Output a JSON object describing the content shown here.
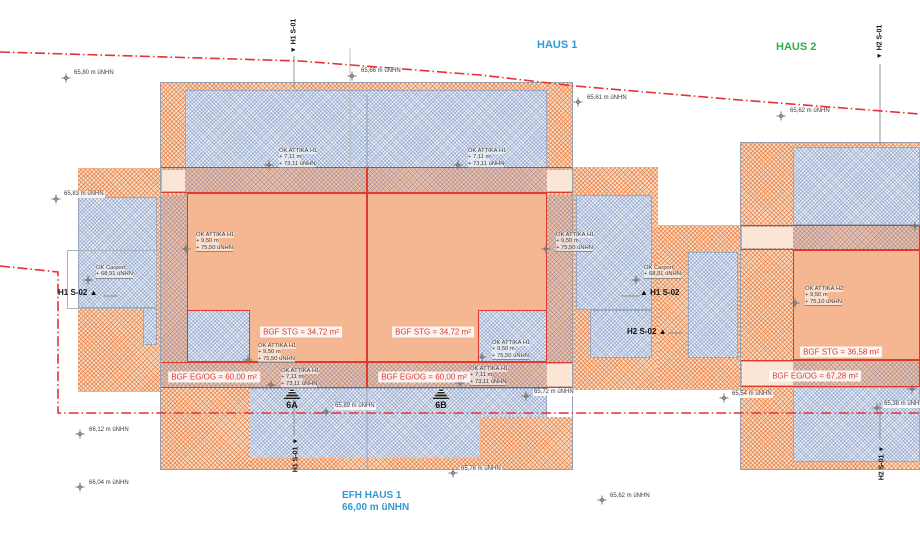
{
  "titles": {
    "haus1": "HAUS 1",
    "haus2": "HAUS 2",
    "efh_line1": "EFH HAUS 1",
    "efh_line2": "66,00 m üNHN"
  },
  "colors": {
    "haus1_title": "#2e9bd6",
    "haus2_title": "#2fae4e",
    "bgf_text": "#e0342c",
    "boundary_red": "#e63137"
  },
  "elevation_markers": [
    {
      "label": "65,80 m üNHN",
      "x": 73,
      "y": 70,
      "cx": 66,
      "cy": 78
    },
    {
      "label": "65,66 m üNHN",
      "x": 360,
      "y": 68,
      "cx": 352,
      "cy": 76
    },
    {
      "label": "65,61 m üNHN",
      "x": 586,
      "y": 95,
      "cx": 578,
      "cy": 102
    },
    {
      "label": "65,62 m üNHN",
      "x": 789,
      "y": 108,
      "cx": 781,
      "cy": 116
    },
    {
      "label": "65,83 m üNHN",
      "x": 63,
      "y": 191,
      "cx": 56,
      "cy": 199
    },
    {
      "label": "65,89 m üNHN",
      "x": 334,
      "y": 403,
      "cx": 326,
      "cy": 412
    },
    {
      "label": "65,72 m üNHN",
      "x": 533,
      "y": 389,
      "cx": 526,
      "cy": 396
    },
    {
      "label": "65,54 m üNHN",
      "x": 731,
      "y": 391,
      "cx": 724,
      "cy": 398
    },
    {
      "label": "65,38 m üNHN",
      "x": 883,
      "y": 401,
      "cx": 877,
      "cy": 408
    },
    {
      "label": "66,12 m üNHN",
      "x": 88,
      "y": 427,
      "cx": 80,
      "cy": 434
    },
    {
      "label": "66,04 m üNHN",
      "x": 88,
      "y": 480,
      "cx": 80,
      "cy": 487
    },
    {
      "label": "65,76 m üNHN",
      "x": 460,
      "y": 466,
      "cx": 453,
      "cy": 473
    },
    {
      "label": "65,62 m üNHN",
      "x": 609,
      "y": 493,
      "cx": 602,
      "cy": 500
    },
    {
      "label": "",
      "x": 0,
      "y": 0,
      "cx": 915,
      "cy": 226
    },
    {
      "label": "",
      "x": 0,
      "y": 0,
      "cx": 912,
      "cy": 389
    }
  ],
  "carport_markers": [
    {
      "lines": [
        "OK Carport",
        "+ 68,91 üNHN"
      ],
      "x": 96,
      "y": 265,
      "cx": 88,
      "cy": 280
    },
    {
      "lines": [
        "OK Carport",
        "+ 68,91 üNHN"
      ],
      "x": 644,
      "y": 265,
      "cx": 636,
      "cy": 280
    }
  ],
  "attika_labels": [
    {
      "lines": [
        "OK ATTIKA H1",
        "+ 7,11 m",
        "+ 73,11 üNHN"
      ],
      "x": 279,
      "y": 148
    },
    {
      "lines": [
        "OK ATTIKA H1",
        "+ 7,11 m",
        "+ 73,11 üNHN"
      ],
      "x": 468,
      "y": 148
    },
    {
      "lines": [
        "OK ATTIKA H1",
        "+ 9,50 m",
        "+ 75,50 üNHN"
      ],
      "x": 196,
      "y": 232
    },
    {
      "lines": [
        "OK ATTIKA H1",
        "+ 9,50 m",
        "+ 75,50 üNHN"
      ],
      "x": 556,
      "y": 232
    },
    {
      "lines": [
        "OK ATTIKA H1",
        "+ 9,50 m",
        "+ 75,50 üNHN"
      ],
      "x": 258,
      "y": 343
    },
    {
      "lines": [
        "OK ATTIKA H1",
        "+ 9,50 m",
        "+ 75,50 üNHN"
      ],
      "x": 492,
      "y": 340
    },
    {
      "lines": [
        "OK ATTIKA H1",
        "+ 7,11 m",
        "+ 73,11 üNHN"
      ],
      "x": 281,
      "y": 368
    },
    {
      "lines": [
        "OK ATTIKA H1",
        "+ 7,11 m",
        "+ 73,11 üNHN"
      ],
      "x": 470,
      "y": 366
    },
    {
      "lines": [
        "OK ATTIKA H2",
        "+ 9,50 m",
        "+ 75,10 üNHN"
      ],
      "x": 805,
      "y": 286
    }
  ],
  "bgf_labels": [
    {
      "label": "BGF STG = 34,72 m²",
      "x": 301,
      "y": 332
    },
    {
      "label": "BGF STG = 34,72 m²",
      "x": 433,
      "y": 332
    },
    {
      "label": "BGF EG/OG = 60,00 m²",
      "x": 214,
      "y": 377
    },
    {
      "label": "BGF EG/OG = 60,00 m²",
      "x": 424,
      "y": 377
    },
    {
      "label": "BGF STG = 36,58 m²",
      "x": 841,
      "y": 352
    },
    {
      "label": "BGF EG/OG = 67,28 m²",
      "x": 815,
      "y": 376
    }
  ],
  "section_markers": {
    "vertical": [
      {
        "label": "▼ H1 S-01",
        "x": 294,
        "y": 36
      },
      {
        "label": "H1 S-01 ▼",
        "x": 296,
        "y": 455
      },
      {
        "label": "▼ H2 S-01",
        "x": 880,
        "y": 42
      },
      {
        "label": "H2 S-01 ▼",
        "x": 882,
        "y": 463
      }
    ],
    "horizontal": [
      {
        "label": "H1 S-02 ▲",
        "x": 58,
        "y": 288
      },
      {
        "label": "▲ H1 S-02",
        "x": 640,
        "y": 288
      },
      {
        "label": "H2 S-02 ▲",
        "x": 627,
        "y": 327
      }
    ]
  },
  "unit_markers": [
    {
      "label": "6A",
      "x": 292,
      "y": 400
    },
    {
      "label": "6B",
      "x": 441,
      "y": 400
    }
  ]
}
